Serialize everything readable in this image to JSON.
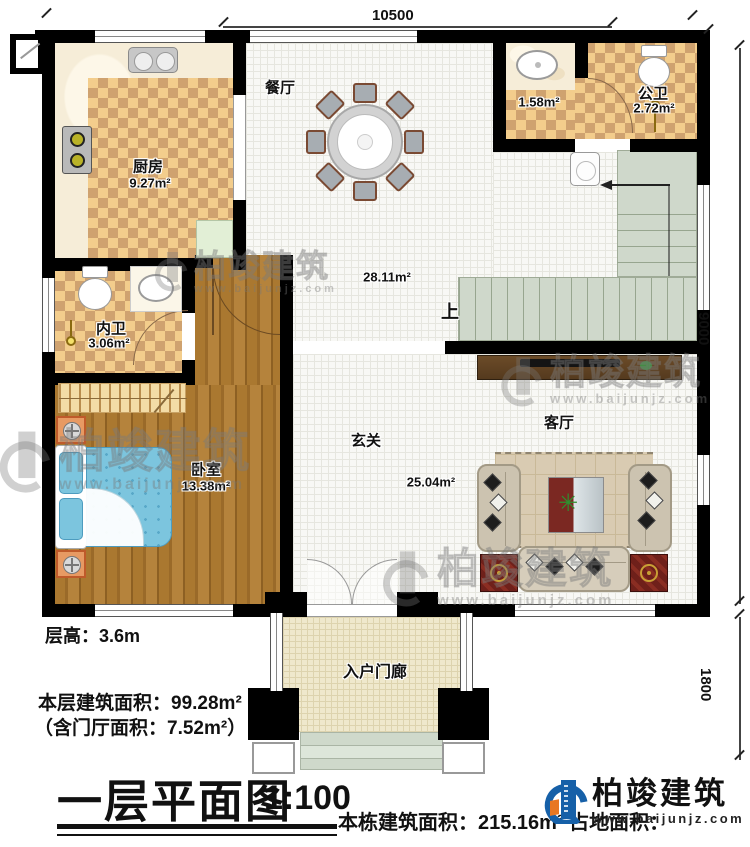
{
  "plan": {
    "rooms": {
      "dining": {
        "name": "餐厅",
        "area": "28.11m²"
      },
      "kitchen": {
        "name": "厨房",
        "area": "9.27m²"
      },
      "public_bath": {
        "name": "公卫",
        "area": "2.72m²"
      },
      "washroom": {
        "area": "1.58m²"
      },
      "ensuite_bath": {
        "name": "内卫",
        "area": "3.06m²"
      },
      "bedroom": {
        "name": "卧室",
        "area": "13.38m²"
      },
      "foyer": {
        "name": "玄关",
        "area": "25.04m²"
      },
      "living": {
        "name": "客厅"
      },
      "porch": {
        "name": "入户门廊"
      },
      "stairs": {
        "up_label": "上"
      }
    },
    "dimensions": {
      "top": "10500",
      "right_main": "9000",
      "right_porch": "1800"
    }
  },
  "annotations": {
    "floor_height": "层高：3.6m",
    "floor_area": "本层建筑面积：99.28m²",
    "foyer_area_note": "（含门厅面积：7.52m²）",
    "title": "一层平面图",
    "scale": "1:100",
    "building_total_area": "本栋建筑面积：215.16m²",
    "land_area_label": "占地面积："
  },
  "brand": {
    "name": "柏竣建筑",
    "website": "www.baijunjz.com"
  },
  "watermark": {
    "name": "柏竣建筑",
    "website": "www.baijunjz.com"
  },
  "icons": {
    "plant": "✳"
  },
  "colors": {
    "wall": "#000000",
    "checker_light": "#f3cd8c",
    "checker_dark": "#cfa26f",
    "wood": "#a9772f",
    "stair": "#cfd8cb",
    "porch": "#efe8cc",
    "bed": "#7cc5de",
    "logo_blue": "#1660a8",
    "logo_orange": "#e87722"
  }
}
